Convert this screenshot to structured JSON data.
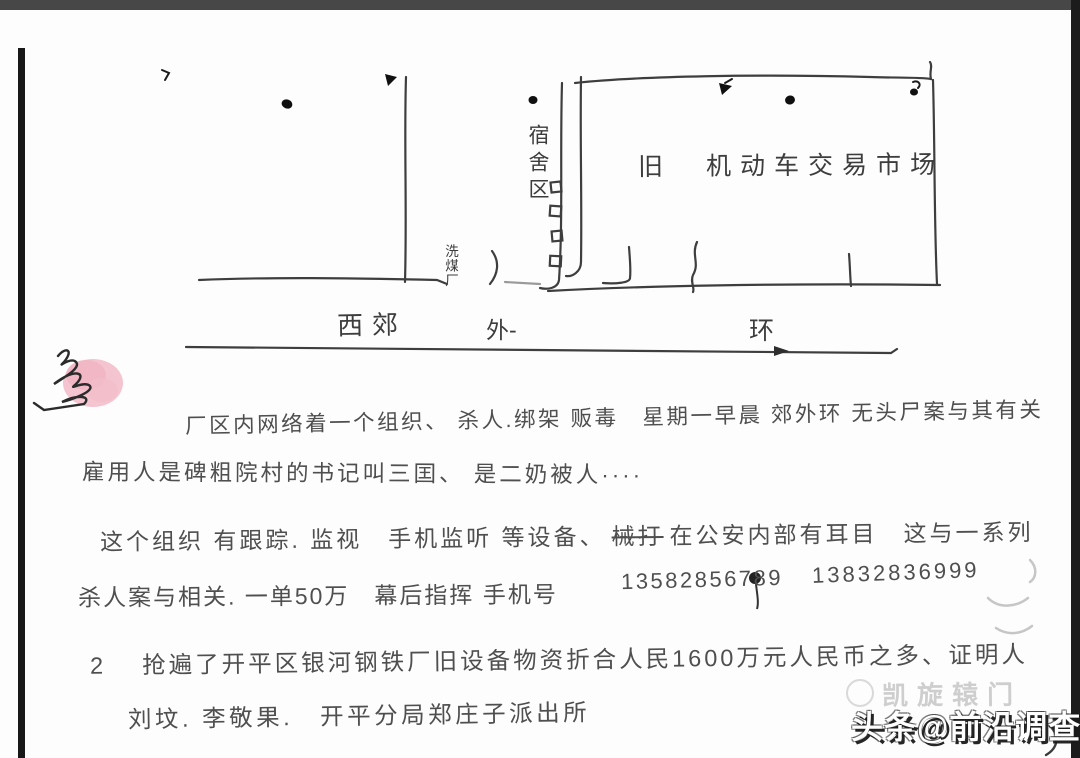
{
  "scan": {
    "map": {
      "dormitory_label": "宿舍区",
      "market_label": "旧　机动车交易市场",
      "coal_plant_label": "洗煤厂",
      "road": [
        "西郊",
        "外-",
        "环"
      ]
    },
    "notes": {
      "line1": "厂区内网络着一个组织、 杀人.绑架 贩毒　星期一早晨 郊外环 无头尸案与其有关",
      "line2": "雇用人是碑粗院村的书记叫三囯、 是二奶被人····",
      "line3_pre": "这个组织 有跟踪. 监视　手机监听 等设备、",
      "line3_struck": "械打",
      "line3_post": "在公安内部有耳目　这与一系列",
      "line4_pre": "杀人案与相关. 一单50万　幕后指挥 手机号",
      "line4_phone1": "13582856789",
      "line4_phone2": "13832836999",
      "line5": "2　 抢遍了开平区银河钢铁厂旧设备物资折合人民1600万元人民币之多、证明人",
      "line6": "刘坟. 李敬果.　开平分局郑庄子派出所"
    },
    "watermark": {
      "faint": "凯旋辕门",
      "main": "头条@前沿调查"
    }
  }
}
